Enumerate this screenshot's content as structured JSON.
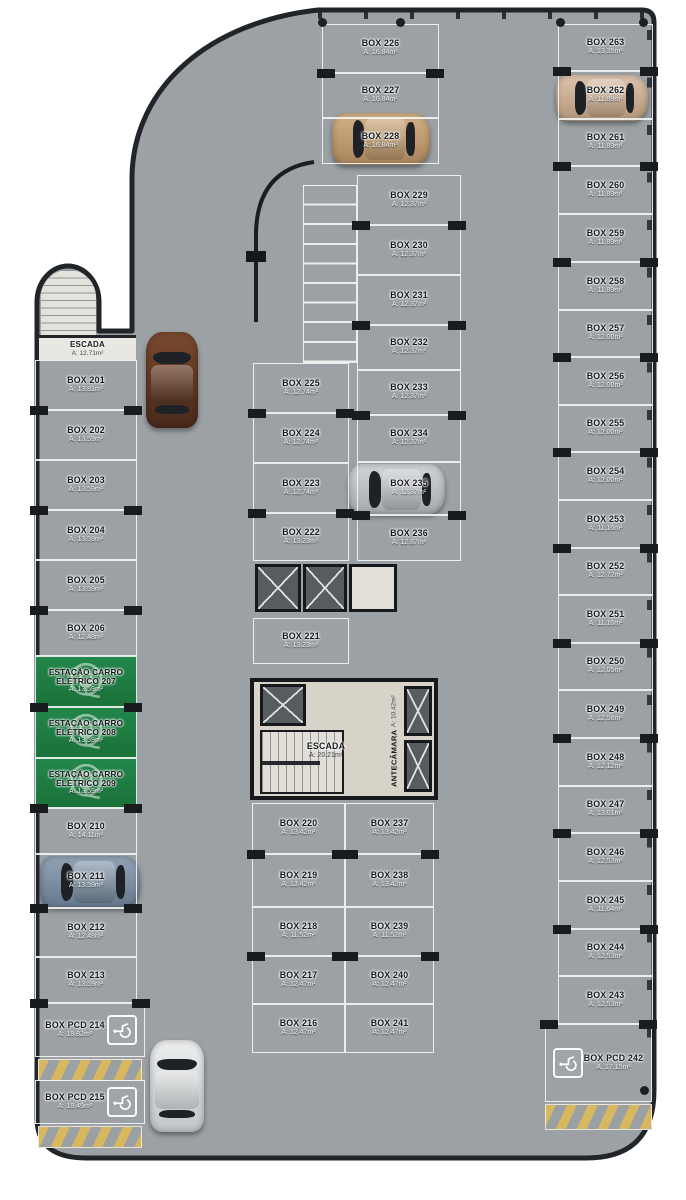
{
  "palette": {
    "floor": "#9ba1a4",
    "wall": "#212428",
    "line": "#f5f6f6",
    "ev_green": "#1f7d3f",
    "hatch_yellow": "#d8b85f"
  },
  "tower": {
    "label": "ESCADA",
    "area": "A: 12.71m²"
  },
  "core": {
    "escada": {
      "label": "ESCADA",
      "area": "A: 20.21m²"
    },
    "antecamara": {
      "label": "ANTECÂMARA",
      "area": "A: 10.42m²"
    }
  },
  "stalls": [
    {
      "id": "201",
      "label": "BOX 201",
      "area": "A: 13.81m²",
      "x": 35,
      "y": 360,
      "w": 102,
      "h": 50,
      "type": "std",
      "tick": 0
    },
    {
      "id": "202",
      "label": "BOX 202",
      "area": "A: 13.59m²",
      "x": 35,
      "y": 410,
      "w": 102,
      "h": 50,
      "type": "std",
      "tick": 1
    },
    {
      "id": "203",
      "label": "BOX 203",
      "area": "A: 13.59m²",
      "x": 35,
      "y": 460,
      "w": 102,
      "h": 50,
      "type": "std",
      "tick": 0
    },
    {
      "id": "204",
      "label": "BOX 204",
      "area": "A: 13.59m²",
      "x": 35,
      "y": 510,
      "w": 102,
      "h": 50,
      "type": "std",
      "tick": 1
    },
    {
      "id": "205",
      "label": "BOX 205",
      "area": "A: 13.59m²",
      "x": 35,
      "y": 560,
      "w": 102,
      "h": 50,
      "type": "std",
      "tick": 0
    },
    {
      "id": "206",
      "label": "BOX 206",
      "area": "A: 12.48m²",
      "x": 35,
      "y": 610,
      "w": 102,
      "h": 46,
      "type": "std",
      "tick": 1
    },
    {
      "id": "207",
      "label": "ESTAÇÃO CARRO ELÉTRICO 207",
      "area": "A: 13.59m²",
      "x": 35,
      "y": 656,
      "w": 102,
      "h": 51,
      "type": "ev",
      "tick": 0
    },
    {
      "id": "208",
      "label": "ESTAÇÃO CARRO ELÉTRICO 208",
      "area": "A: 13.59m²",
      "x": 35,
      "y": 707,
      "w": 102,
      "h": 51,
      "type": "ev",
      "tick": 1
    },
    {
      "id": "209",
      "label": "ESTAÇÃO CARRO ELÉTRICO 209",
      "area": "A: 13.59m²",
      "x": 35,
      "y": 758,
      "w": 102,
      "h": 50,
      "type": "ev",
      "tick": 0
    },
    {
      "id": "210",
      "label": "BOX 210",
      "area": "A: 14.11m²",
      "x": 35,
      "y": 808,
      "w": 102,
      "h": 46,
      "type": "std",
      "tick": 1
    },
    {
      "id": "211",
      "label": "BOX 211",
      "area": "A: 13.59m²",
      "x": 35,
      "y": 854,
      "w": 102,
      "h": 54,
      "type": "std",
      "tick": 0
    },
    {
      "id": "212",
      "label": "BOX 212",
      "area": "A: 12.48m²",
      "x": 35,
      "y": 908,
      "w": 102,
      "h": 49,
      "type": "std",
      "tick": 1
    },
    {
      "id": "213",
      "label": "BOX 213",
      "area": "A: 13.59m²",
      "x": 35,
      "y": 957,
      "w": 102,
      "h": 46,
      "type": "std",
      "tick": 0
    },
    {
      "id": "214",
      "label": "BOX PCD 214",
      "area": "A: 19.82m²",
      "x": 35,
      "y": 1003,
      "w": 110,
      "h": 54,
      "type": "pcd",
      "icon": "right",
      "tick": 1
    },
    {
      "id": "215",
      "label": "BOX PCD 215",
      "area": "A: 19.49m²",
      "x": 35,
      "y": 1080,
      "w": 110,
      "h": 44,
      "type": "pcd",
      "icon": "right",
      "tick": 0
    },
    {
      "id": "225",
      "label": "BOX 225",
      "area": "A: 12.74m²",
      "x": 253,
      "y": 363,
      "w": 96,
      "h": 50,
      "type": "std",
      "tick": 0
    },
    {
      "id": "224",
      "label": "BOX 224",
      "area": "A: 12.74m²",
      "x": 253,
      "y": 413,
      "w": 96,
      "h": 50,
      "type": "std",
      "tick": 1
    },
    {
      "id": "223",
      "label": "BOX 223",
      "area": "A: 12.74m²",
      "x": 253,
      "y": 463,
      "w": 96,
      "h": 50,
      "type": "std",
      "tick": 0
    },
    {
      "id": "222",
      "label": "BOX 222",
      "area": "A: 13.23m²",
      "x": 253,
      "y": 513,
      "w": 96,
      "h": 48,
      "type": "std",
      "tick": 1
    },
    {
      "id": "221",
      "label": "BOX 221",
      "area": "A: 13.23m²",
      "x": 253,
      "y": 618,
      "w": 96,
      "h": 46,
      "type": "std",
      "tick": 0
    },
    {
      "id": "226",
      "label": "BOX 226",
      "area": "A: 16.84m²",
      "x": 322,
      "y": 24,
      "w": 117,
      "h": 49,
      "type": "std",
      "tick": 0
    },
    {
      "id": "227",
      "label": "BOX 227",
      "area": "A: 16.84m²",
      "x": 322,
      "y": 73,
      "w": 117,
      "h": 45,
      "type": "std",
      "tick": 1
    },
    {
      "id": "228",
      "label": "BOX 228",
      "area": "A: 16.84m²",
      "x": 322,
      "y": 118,
      "w": 117,
      "h": 46,
      "type": "std",
      "tick": 0
    },
    {
      "id": "229",
      "label": "BOX 229",
      "area": "A: 12.37m²",
      "x": 357,
      "y": 175,
      "w": 104,
      "h": 50,
      "type": "std",
      "tick": 0
    },
    {
      "id": "230",
      "label": "BOX 230",
      "area": "A: 12.37m²",
      "x": 357,
      "y": 225,
      "w": 104,
      "h": 50,
      "type": "std",
      "tick": 1
    },
    {
      "id": "231",
      "label": "BOX 231",
      "area": "A: 12.37m²",
      "x": 357,
      "y": 275,
      "w": 104,
      "h": 50,
      "type": "std",
      "tick": 0
    },
    {
      "id": "232",
      "label": "BOX 232",
      "area": "A: 12.37m²",
      "x": 357,
      "y": 325,
      "w": 104,
      "h": 45,
      "type": "std",
      "tick": 1
    },
    {
      "id": "233",
      "label": "BOX 233",
      "area": "A: 12.37m²",
      "x": 357,
      "y": 370,
      "w": 104,
      "h": 45,
      "type": "std",
      "tick": 0
    },
    {
      "id": "234",
      "label": "BOX 234",
      "area": "A: 12.37m²",
      "x": 357,
      "y": 415,
      "w": 104,
      "h": 47,
      "type": "std",
      "tick": 1
    },
    {
      "id": "235",
      "label": "BOX 235",
      "area": "A: 12.37m²",
      "x": 357,
      "y": 462,
      "w": 104,
      "h": 53,
      "type": "std",
      "tick": 0
    },
    {
      "id": "236",
      "label": "BOX 236",
      "area": "A: 12.87m²",
      "x": 357,
      "y": 515,
      "w": 104,
      "h": 46,
      "type": "std",
      "tick": 1
    },
    {
      "id": "220",
      "label": "BOX 220",
      "area": "A: 13.42m²",
      "x": 252,
      "y": 803,
      "w": 93,
      "h": 51,
      "type": "std",
      "tick": 0
    },
    {
      "id": "219",
      "label": "BOX 219",
      "area": "A: 13.42m²",
      "x": 252,
      "y": 854,
      "w": 93,
      "h": 53,
      "type": "std",
      "tick": 1
    },
    {
      "id": "218",
      "label": "BOX 218",
      "area": "A: 11.52m²",
      "x": 252,
      "y": 907,
      "w": 93,
      "h": 49,
      "type": "std",
      "tick": 0
    },
    {
      "id": "217",
      "label": "BOX 217",
      "area": "A: 12.47m²",
      "x": 252,
      "y": 956,
      "w": 93,
      "h": 48,
      "type": "std",
      "tick": 1
    },
    {
      "id": "216",
      "label": "BOX 216",
      "area": "A: 12.47m²",
      "x": 252,
      "y": 1004,
      "w": 93,
      "h": 49,
      "type": "std",
      "tick": 0
    },
    {
      "id": "237",
      "label": "BOX 237",
      "area": "A: 13.42m²",
      "x": 345,
      "y": 803,
      "w": 89,
      "h": 51,
      "type": "std",
      "tick": 0
    },
    {
      "id": "238",
      "label": "BOX 238",
      "area": "A: 13.42m²",
      "x": 345,
      "y": 854,
      "w": 89,
      "h": 53,
      "type": "std",
      "tick": 1
    },
    {
      "id": "239",
      "label": "BOX 239",
      "area": "A: 11.52m²",
      "x": 345,
      "y": 907,
      "w": 89,
      "h": 49,
      "type": "std",
      "tick": 0
    },
    {
      "id": "240",
      "label": "BOX 240",
      "area": "A: 12.47m²",
      "x": 345,
      "y": 956,
      "w": 89,
      "h": 48,
      "type": "std",
      "tick": 1
    },
    {
      "id": "241",
      "label": "BOX 241",
      "area": "A: 12.47m²",
      "x": 345,
      "y": 1004,
      "w": 89,
      "h": 49,
      "type": "std",
      "tick": 0
    },
    {
      "id": "263",
      "label": "BOX 263",
      "area": "A: 13.35m²",
      "x": 558,
      "y": 24,
      "w": 95,
      "h": 47,
      "type": "std",
      "tick": 0
    },
    {
      "id": "262",
      "label": "BOX 262",
      "area": "A: 11.89m²",
      "x": 558,
      "y": 71,
      "w": 95,
      "h": 48,
      "type": "std",
      "tick": 1
    },
    {
      "id": "261",
      "label": "BOX 261",
      "area": "A: 11.89m²",
      "x": 558,
      "y": 119,
      "w": 95,
      "h": 47,
      "type": "std",
      "tick": 0
    },
    {
      "id": "260",
      "label": "BOX 260",
      "area": "A: 11.89m²",
      "x": 558,
      "y": 166,
      "w": 95,
      "h": 48,
      "type": "std",
      "tick": 1
    },
    {
      "id": "259",
      "label": "BOX 259",
      "area": "A: 11.89m²",
      "x": 558,
      "y": 214,
      "w": 95,
      "h": 48,
      "type": "std",
      "tick": 0
    },
    {
      "id": "258",
      "label": "BOX 258",
      "area": "A: 11.89m²",
      "x": 558,
      "y": 262,
      "w": 95,
      "h": 48,
      "type": "std",
      "tick": 1
    },
    {
      "id": "257",
      "label": "BOX 257",
      "area": "A: 12.00m²",
      "x": 558,
      "y": 310,
      "w": 95,
      "h": 47,
      "type": "std",
      "tick": 0
    },
    {
      "id": "256",
      "label": "BOX 256",
      "area": "A: 12.00m²",
      "x": 558,
      "y": 357,
      "w": 95,
      "h": 48,
      "type": "std",
      "tick": 1
    },
    {
      "id": "255",
      "label": "BOX 255",
      "area": "A: 12.00m²",
      "x": 558,
      "y": 405,
      "w": 95,
      "h": 47,
      "type": "std",
      "tick": 0
    },
    {
      "id": "254",
      "label": "BOX 254",
      "area": "A: 12.00m²",
      "x": 558,
      "y": 452,
      "w": 95,
      "h": 48,
      "type": "std",
      "tick": 1
    },
    {
      "id": "253",
      "label": "BOX 253",
      "area": "A: 11.16m²",
      "x": 558,
      "y": 500,
      "w": 95,
      "h": 48,
      "type": "std",
      "tick": 0
    },
    {
      "id": "252",
      "label": "BOX 252",
      "area": "A: 12.72m²",
      "x": 558,
      "y": 548,
      "w": 95,
      "h": 47,
      "type": "std",
      "tick": 1
    },
    {
      "id": "251",
      "label": "BOX 251",
      "area": "A: 11.16m²",
      "x": 558,
      "y": 595,
      "w": 95,
      "h": 48,
      "type": "std",
      "tick": 0
    },
    {
      "id": "250",
      "label": "BOX 250",
      "area": "A: 12.05m²",
      "x": 558,
      "y": 643,
      "w": 95,
      "h": 47,
      "type": "std",
      "tick": 1
    },
    {
      "id": "249",
      "label": "BOX 249",
      "area": "A: 12.58m²",
      "x": 558,
      "y": 690,
      "w": 95,
      "h": 48,
      "type": "std",
      "tick": 0
    },
    {
      "id": "248",
      "label": "BOX 248",
      "area": "A: 12.12m²",
      "x": 558,
      "y": 738,
      "w": 95,
      "h": 48,
      "type": "std",
      "tick": 1
    },
    {
      "id": "247",
      "label": "BOX 247",
      "area": "A: 13.01m²",
      "x": 558,
      "y": 786,
      "w": 95,
      "h": 47,
      "type": "std",
      "tick": 0
    },
    {
      "id": "246",
      "label": "BOX 246",
      "area": "A: 12.53m²",
      "x": 558,
      "y": 833,
      "w": 95,
      "h": 48,
      "type": "std",
      "tick": 1
    },
    {
      "id": "245",
      "label": "BOX 245",
      "area": "A: 11.64m²",
      "x": 558,
      "y": 881,
      "w": 95,
      "h": 48,
      "type": "std",
      "tick": 0
    },
    {
      "id": "244",
      "label": "BOX 244",
      "area": "A: 12.53m²",
      "x": 558,
      "y": 929,
      "w": 95,
      "h": 47,
      "type": "std",
      "tick": 1
    },
    {
      "id": "243",
      "label": "BOX 243",
      "area": "A: 12.53m²",
      "x": 558,
      "y": 976,
      "w": 95,
      "h": 48,
      "type": "std",
      "tick": 0
    },
    {
      "id": "242",
      "label": "BOX PCD 242",
      "area": "A: 17.15m²",
      "x": 545,
      "y": 1024,
      "w": 107,
      "h": 78,
      "type": "pcd",
      "icon": "left",
      "tick": 1
    }
  ],
  "shafts": [
    {
      "x": 255,
      "y": 564,
      "w": 46,
      "h": 48
    },
    {
      "x": 303,
      "y": 564,
      "w": 44,
      "h": 48
    },
    {
      "x": 260,
      "y": 684,
      "w": 46,
      "h": 42
    },
    {
      "x": 404,
      "y": 686,
      "w": 28,
      "h": 50
    },
    {
      "x": 404,
      "y": 740,
      "w": 28,
      "h": 52
    }
  ],
  "rooms": [
    {
      "x": 349,
      "y": 564,
      "w": 48,
      "h": 48
    }
  ],
  "hatches": [
    {
      "x": 38,
      "y": 1059,
      "w": 104,
      "h": 22
    },
    {
      "x": 38,
      "y": 1126,
      "w": 104,
      "h": 22
    },
    {
      "x": 545,
      "y": 1104,
      "w": 107,
      "h": 26
    }
  ],
  "dots": [
    [
      322,
      22
    ],
    [
      400,
      22
    ],
    [
      560,
      22
    ],
    [
      643,
      22
    ],
    [
      644,
      1090
    ]
  ],
  "cars": [
    {
      "id": "car-gold",
      "c1": "#d3b186",
      "c2": "#a8845b",
      "x": 332,
      "y": 113,
      "w": 98,
      "h": 52,
      "orient": "h"
    },
    {
      "id": "car-beige",
      "c1": "#dec4ae",
      "c2": "#b29679",
      "x": 556,
      "y": 75,
      "w": 92,
      "h": 46,
      "orient": "h"
    },
    {
      "id": "car-silver",
      "c1": "#d2d5d8",
      "c2": "#a6aaad",
      "x": 349,
      "y": 464,
      "w": 96,
      "h": 50,
      "orient": "h"
    },
    {
      "id": "car-brown",
      "c1": "#7a4a30",
      "c2": "#49291a",
      "x": 146,
      "y": 332,
      "w": 52,
      "h": 96,
      "orient": "v"
    },
    {
      "id": "car-blue",
      "c1": "#93a4b6",
      "c2": "#66788c",
      "x": 40,
      "y": 856,
      "w": 100,
      "h": 52,
      "orient": "h"
    },
    {
      "id": "car-white",
      "c1": "#eceeef",
      "c2": "#c2c6c9",
      "x": 150,
      "y": 1040,
      "w": 54,
      "h": 92,
      "orient": "v"
    }
  ]
}
